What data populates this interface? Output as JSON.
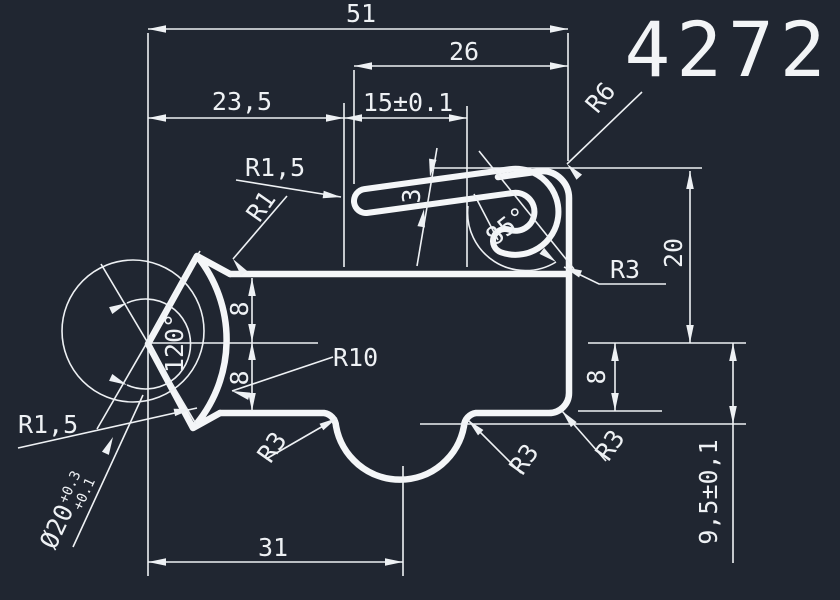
{
  "colors": {
    "background": "#202631",
    "line": "#f2f4f6"
  },
  "drawing": {
    "number": "4272",
    "type": "profile-cross-section"
  },
  "labels": {
    "drawing_number": "4272",
    "dim_51": "51",
    "dim_26": "26",
    "dim_23_5": "23,5",
    "dim_15": "15±0.1",
    "dim_3": "3",
    "dim_8_left_upper": "8",
    "dim_8_left_lower": "8",
    "dim_31": "31",
    "dim_20_right": "20",
    "dim_8_right": "8",
    "dim_9_5": "9,5±0,1",
    "angle_120": "120°",
    "angle_85": "85°",
    "radius_r10": "R10",
    "radius_r6": "R6",
    "radius_r1": "R1",
    "radius_r1_5_top": "R1,5",
    "radius_r1_5_bottom": "R1,5",
    "radius_r3_hook": "R3",
    "radius_r3_scallop_left": "R3",
    "radius_r3_scallop_right": "R3",
    "radius_r3_corner": "R3",
    "dia_main": "Ø20",
    "dia_tol_upper": "+0.3",
    "dia_tol_lower": "+0.1"
  }
}
